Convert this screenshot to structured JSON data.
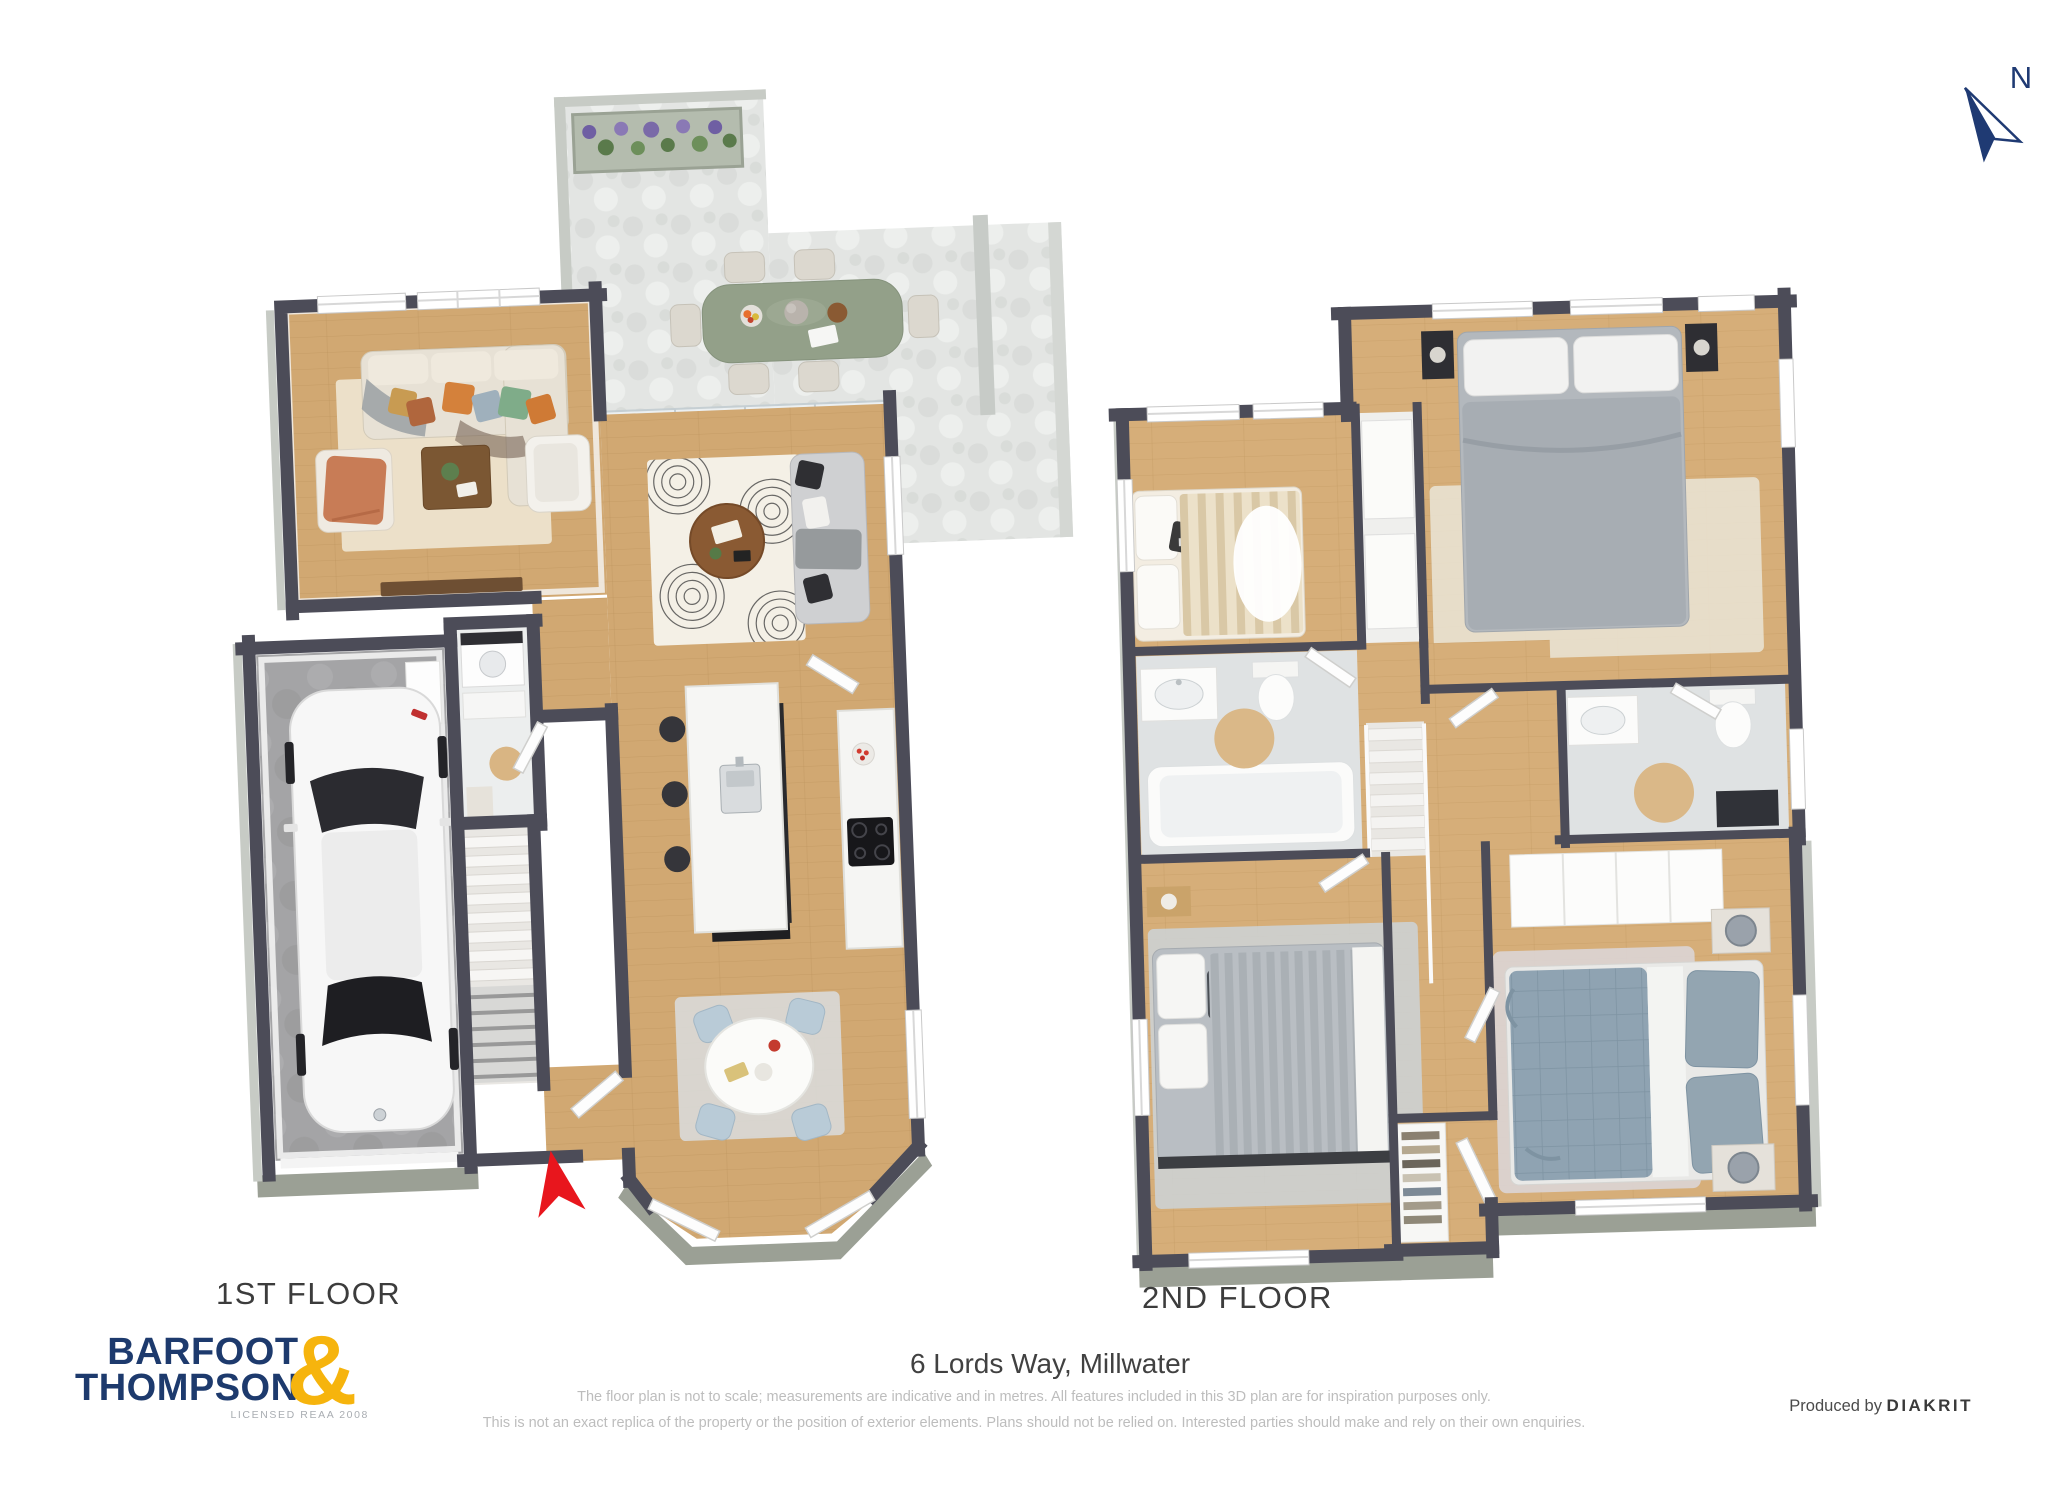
{
  "compass": {
    "label": "N",
    "color": "#1f3a73"
  },
  "floor_labels": {
    "first": "1ST FLOOR",
    "second": "2ND FLOOR"
  },
  "footer": {
    "address": "6 Lords Way, Millwater",
    "disclaimer_line1": "The floor plan is not to scale; measurements are indicative and in metres. All features included in this 3D plan are for inspiration purposes only.",
    "disclaimer_line2": "This is not an exact replica of the property or the position of exterior elements. Plans should not be relied on. Interested parties should make and rely on their own enquiries.",
    "produced_by": "Produced by",
    "producer": "DIAKRIT"
  },
  "logo": {
    "word1": "BARFOOT",
    "word2": "THOMPSON",
    "ampersand": "&",
    "license": "LICENSED REAA 2008",
    "navy": "#1d3a6d",
    "gold": "#f6b40d"
  },
  "colors": {
    "wall": "#4c4c58",
    "wood_floor": "#d1a872",
    "deck_stone": "#e3e5e3",
    "garage_floor": "#a4a4a6",
    "bath_tile": "#dfe2e3",
    "entrance_arrow_red": "#e8161d",
    "outdoor_table_green": "#93a089",
    "master_bed_blue": "#8fa3b2"
  }
}
